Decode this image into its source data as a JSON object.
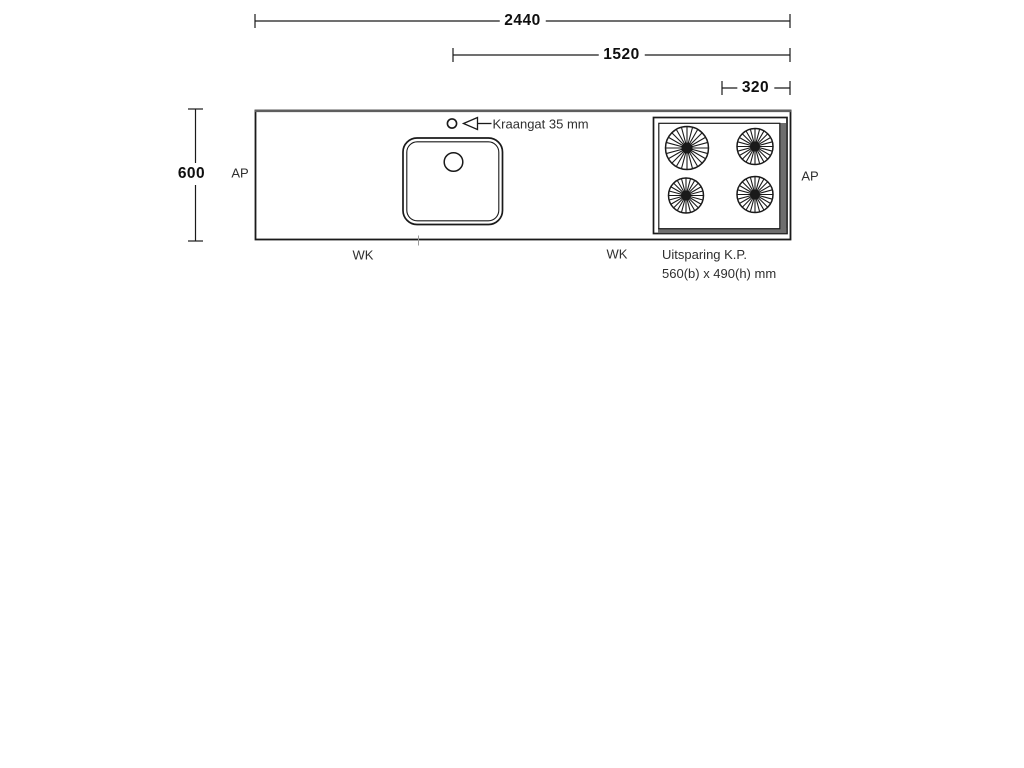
{
  "drawing": {
    "title_meaning": "worktop plan drawing",
    "dimensions": {
      "total": "2440",
      "span": "1520",
      "offset": "320",
      "depth": "600"
    },
    "labels": {
      "ap_left": "AP",
      "ap_right": "AP",
      "wk_left": "WK",
      "wk_mid": "WK",
      "faucet_note": "Kraangat 35 mm",
      "cutout_line1": "Uitsparing K.P.",
      "cutout_line2": "560(b) x 490(h) mm"
    },
    "colors": {
      "line": "#1a1a1a",
      "bevel": "#6e6e6e",
      "top_edge": "#5e5e5e",
      "label_text": "#2f2f2f",
      "dimension_text": "#0f0f0f",
      "background": "#ffffff"
    }
  }
}
